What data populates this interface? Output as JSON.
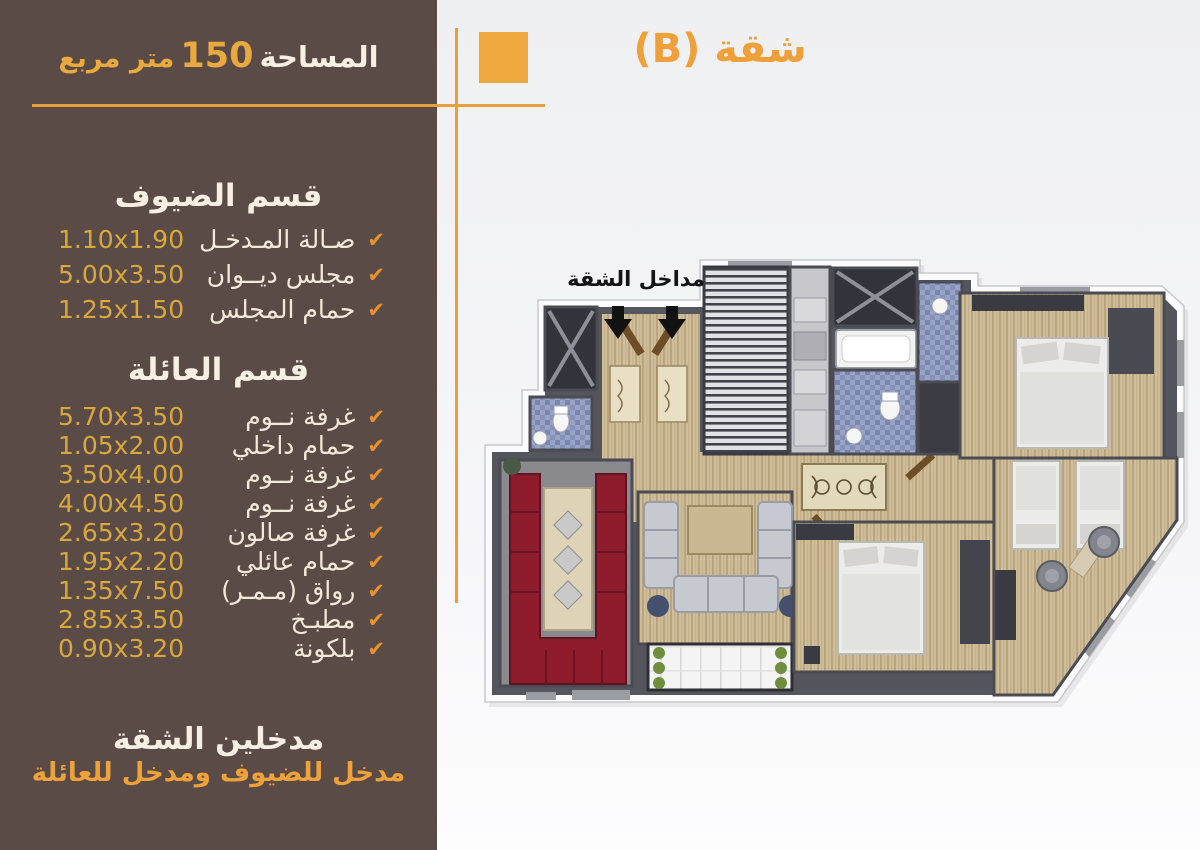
{
  "header": {
    "area_label": "المساحة",
    "area_value": "150",
    "area_unit": "متر مربع",
    "apartment_title": "شقة (B)"
  },
  "icons": {
    "check": "✔"
  },
  "colors": {
    "sidebar_bg": "#5b4b47",
    "accent_orange": "#f0a23c",
    "gold_dims": "#d9a83c",
    "cream_text": "#f5ecdd"
  },
  "sidebar": {
    "guest_section": {
      "title": "قسم الضيوف",
      "items": [
        {
          "dims": "1.10x1.90",
          "name": "صـالة المـدخـل"
        },
        {
          "dims": "5.00x3.50",
          "name": "مجلس ديــوان"
        },
        {
          "dims": "1.25x1.50",
          "name": "حمام المجلس"
        }
      ]
    },
    "family_section": {
      "title": "قسم العائلة",
      "items": [
        {
          "dims": "5.70x3.50",
          "name": "غرفة نــوم"
        },
        {
          "dims": "1.05x2.00",
          "name": "حمام داخلي"
        },
        {
          "dims": "3.50x4.00",
          "name": "غرفة نــوم"
        },
        {
          "dims": "4.00x4.50",
          "name": "غرفة نــوم"
        },
        {
          "dims": "2.65x3.20",
          "name": "غرفة صالون"
        },
        {
          "dims": "1.95x2.20",
          "name": "حمام عائلي"
        },
        {
          "dims": "1.35x7.50",
          "name": "رواق (مـمـر)"
        },
        {
          "dims": "2.85x3.50",
          "name": "مطبـخ"
        },
        {
          "dims": "0.90x3.20",
          "name": "بلكونة"
        }
      ]
    },
    "footer": {
      "line1": "مدخلين الشقة",
      "line2": "مدخل للضيوف ومدخل للعائلة"
    }
  },
  "floor_plan": {
    "entrances_label": "مداخل الشقة"
  }
}
